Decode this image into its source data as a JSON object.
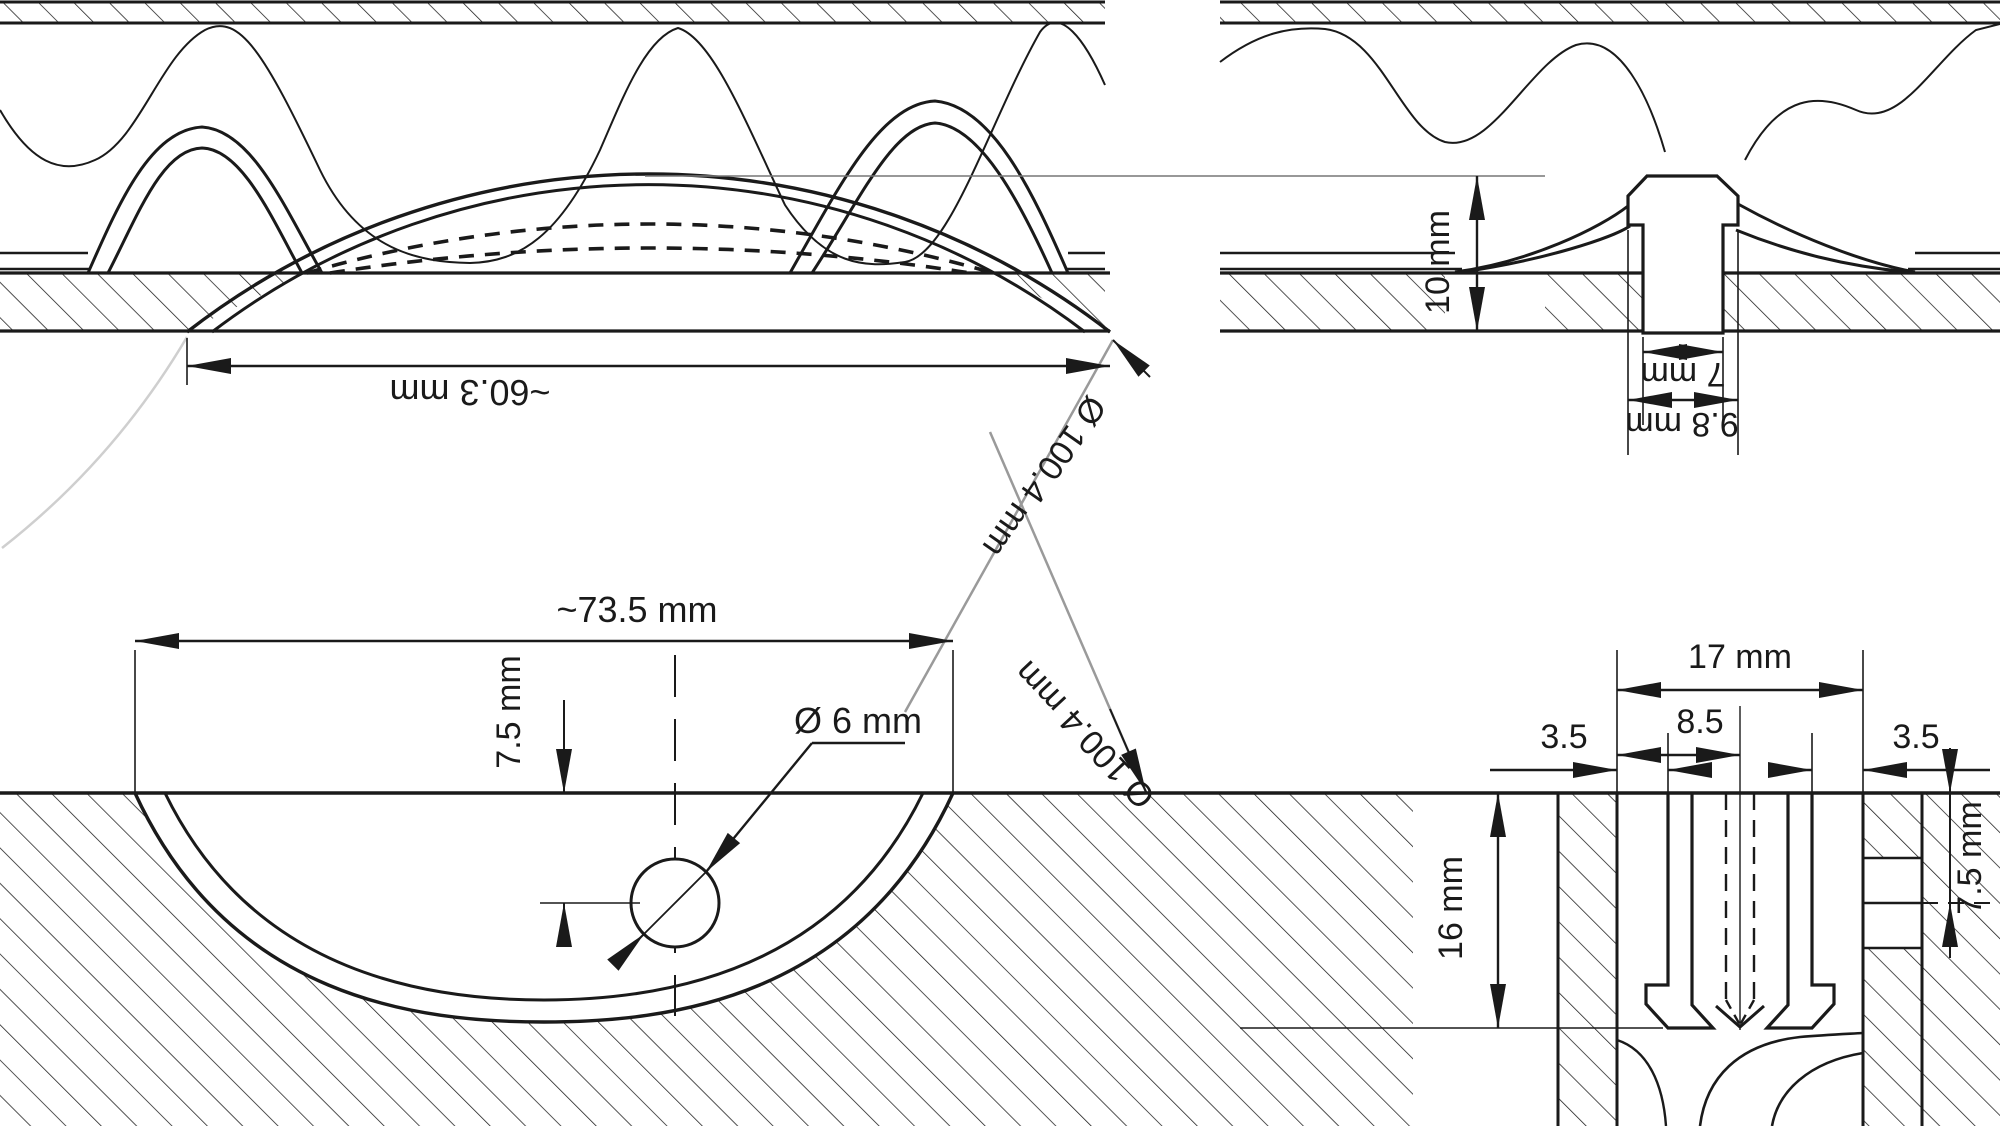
{
  "drawing": {
    "type": "technical-cross-section",
    "panels": [
      "dome-lens-in-corrugated-board-side-view",
      "plug-stud-in-board-side-view",
      "bowl-lens-recessed-block-section",
      "snap-pin-clip-section"
    ]
  },
  "colors": {
    "line": "#1a1a1a",
    "gray_leader": "#9a9a9a",
    "ghost_circle": "#cfcfcf",
    "background": "#ffffff"
  },
  "labels": {
    "top_left": {
      "width": "~60.3 mm",
      "sphere_dia": "Ø 100.4 mm"
    },
    "top_right": {
      "height": "10 mm",
      "inner_width": "7 mm",
      "outer_width": "9.8 mm"
    },
    "bottom_left": {
      "width": "~73.5 mm",
      "depth": "7.5 mm",
      "hole_dia": "Ø  6 mm",
      "sphere_dia": "Ø 100.4 mm"
    },
    "bottom_right": {
      "outer": "17 mm",
      "half": "8.5",
      "left_gap": "3.5",
      "right_gap": "3.5",
      "depth": "16 mm",
      "notch_depth": "7.5 mm"
    }
  }
}
